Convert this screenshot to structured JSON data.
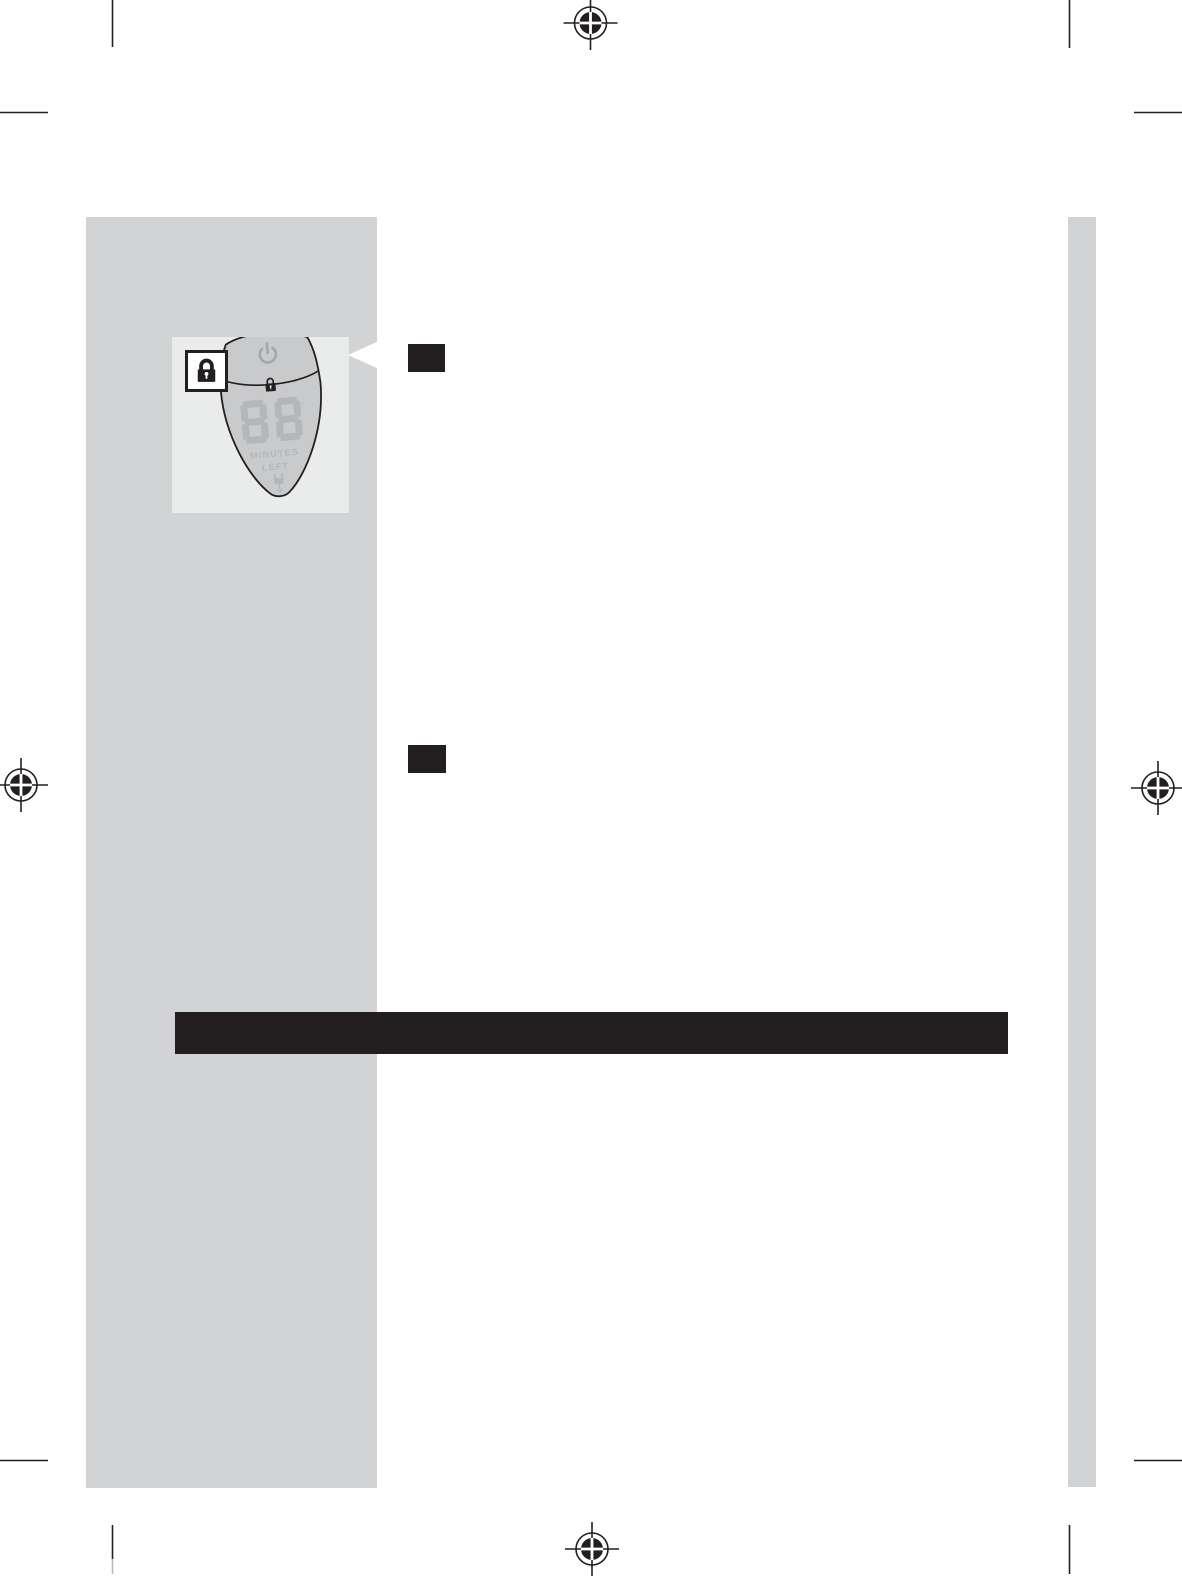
{
  "colors": {
    "sidebar_gray": "#d1d3d4",
    "panel_gray": "#eaebeb",
    "device_body_gray": "#c8cacb",
    "display_gray": "#b4b7b8",
    "ink_black": "#231f20"
  },
  "illustration": {
    "display_value": "88",
    "display_label_line1": "MINUTES",
    "display_label_line2": "LEFT",
    "icons": [
      "power-icon",
      "lock-icon",
      "travel-lock-callout-icon",
      "plug-icon"
    ]
  }
}
